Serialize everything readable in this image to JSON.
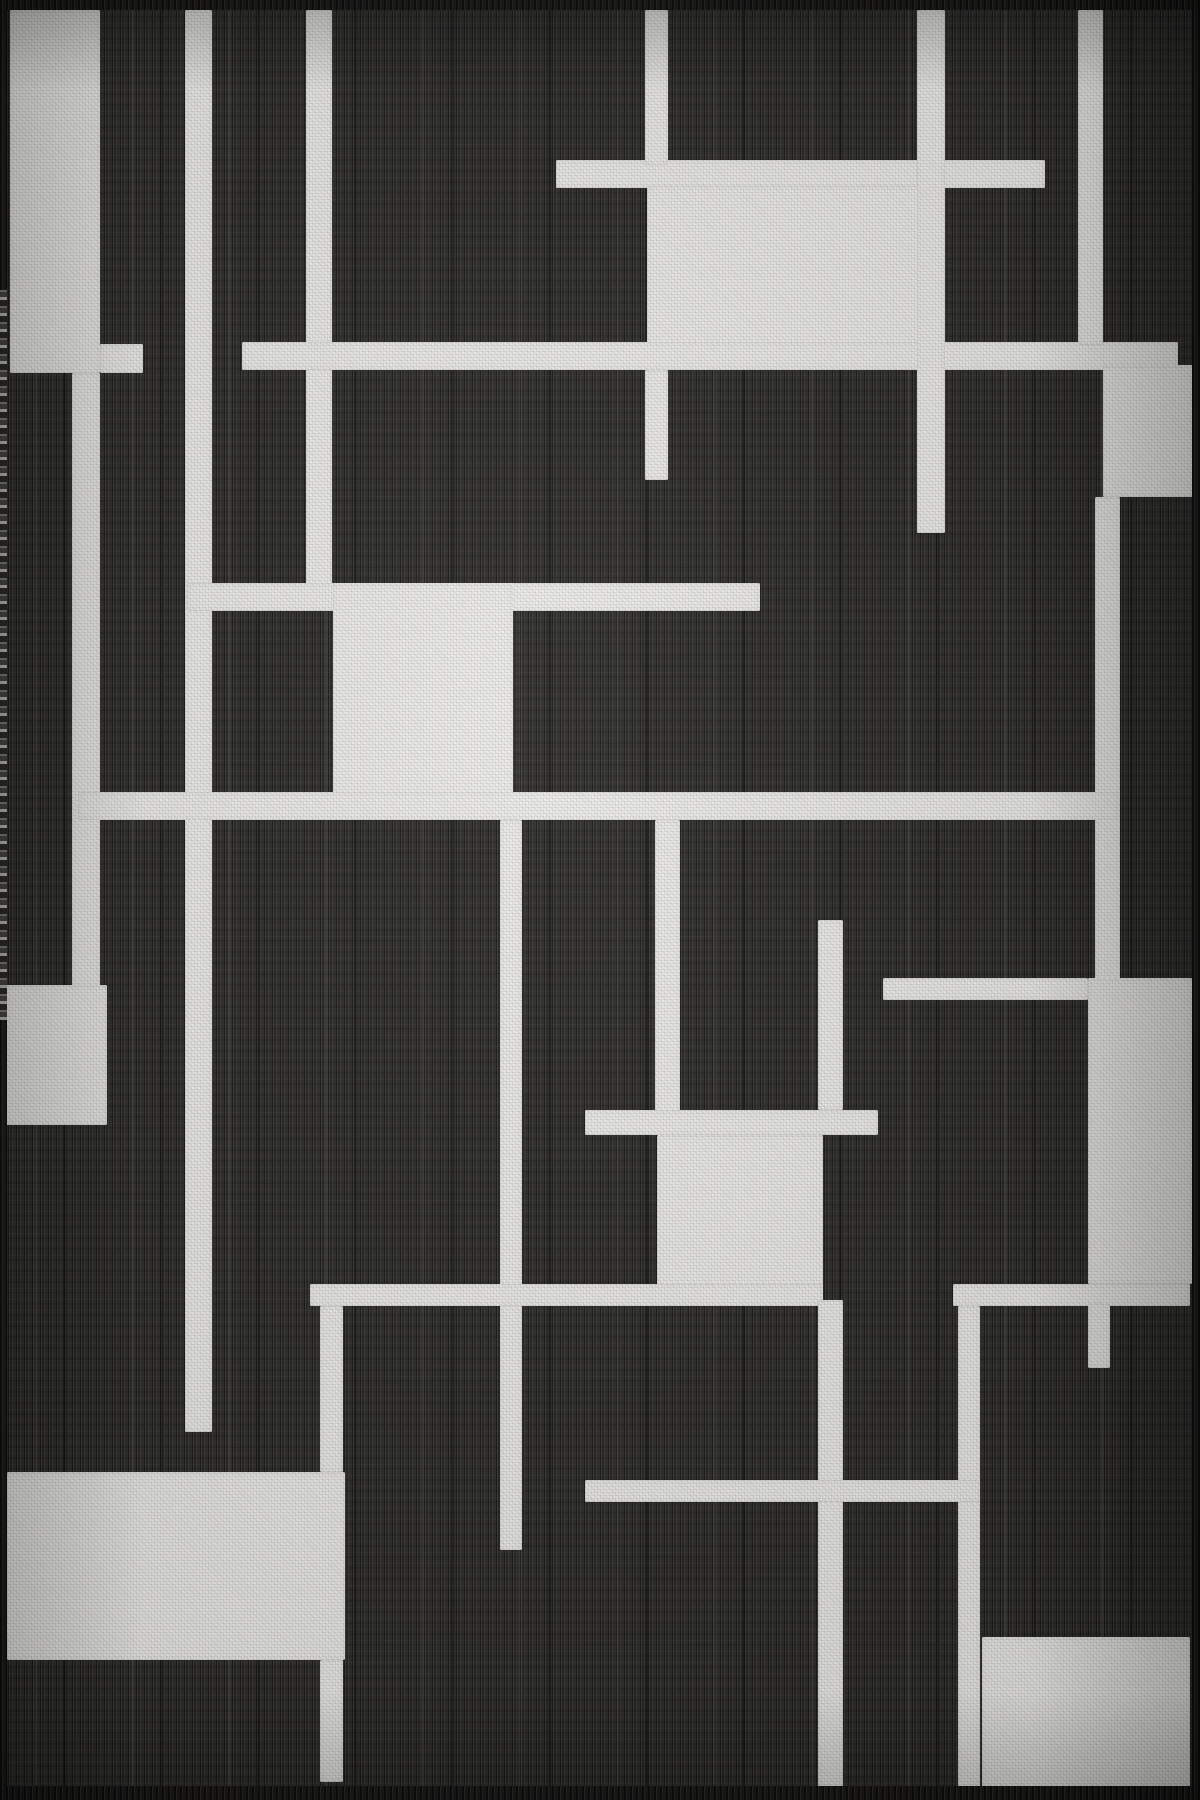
{
  "image": {
    "description": "Flat product photo of a charcoal-black flatweave area rug with an off-white abstract geometric grid pattern of rectangles and intersecting lines, dark selvedge borders and pale fringe on the left edge"
  },
  "rug": {
    "width": 1200,
    "height": 1800,
    "base_color": "#2d2c2a",
    "pattern_color": "#e3e2de",
    "edge_color": "#1b1a18",
    "fringe_color": "#cdcac1",
    "shapes": [
      {
        "name": "rect-left-tall",
        "x": 10,
        "y": 10,
        "w": 90,
        "h": 363
      },
      {
        "name": "arm-left-rect",
        "x": 100,
        "y": 344,
        "w": 43,
        "h": 29
      },
      {
        "name": "strip-left-descender",
        "x": 72,
        "y": 373,
        "w": 28,
        "h": 614
      },
      {
        "name": "rect-left-mid",
        "x": 6,
        "y": 985,
        "w": 101,
        "h": 140
      },
      {
        "name": "vline-1",
        "x": 185,
        "y": 10,
        "w": 27,
        "h": 1422
      },
      {
        "name": "vline-2",
        "x": 306,
        "y": 10,
        "w": 26,
        "h": 601
      },
      {
        "name": "hstrip-top",
        "x": 556,
        "y": 160,
        "w": 489,
        "h": 28
      },
      {
        "name": "vline-3-top",
        "x": 645,
        "y": 10,
        "w": 23,
        "h": 155
      },
      {
        "name": "vline-3-stub",
        "x": 645,
        "y": 370,
        "w": 23,
        "h": 110
      },
      {
        "name": "rect-top-center",
        "x": 647,
        "y": 186,
        "w": 298,
        "h": 184
      },
      {
        "name": "hband-upper",
        "x": 242,
        "y": 342,
        "w": 936,
        "h": 28
      },
      {
        "name": "vline-4",
        "x": 917,
        "y": 10,
        "w": 28,
        "h": 523
      },
      {
        "name": "vline-5",
        "x": 1078,
        "y": 10,
        "w": 25,
        "h": 335
      },
      {
        "name": "rect-right-upper",
        "x": 1103,
        "y": 365,
        "w": 90,
        "h": 132
      },
      {
        "name": "vline-6",
        "x": 1095,
        "y": 497,
        "w": 25,
        "h": 503
      },
      {
        "name": "harm-center",
        "x": 187,
        "y": 583,
        "w": 573,
        "h": 28
      },
      {
        "name": "rect-center-left",
        "x": 333,
        "y": 583,
        "w": 180,
        "h": 237
      },
      {
        "name": "hband-middle",
        "x": 78,
        "y": 792,
        "w": 1040,
        "h": 28
      },
      {
        "name": "vline-12",
        "x": 655,
        "y": 820,
        "w": 25,
        "h": 315
      },
      {
        "name": "vline-8",
        "x": 500,
        "y": 820,
        "w": 22,
        "h": 730
      },
      {
        "name": "vline-10a",
        "x": 818,
        "y": 920,
        "w": 25,
        "h": 190
      },
      {
        "name": "harm-h8",
        "x": 585,
        "y": 1110,
        "w": 293,
        "h": 25
      },
      {
        "name": "rect-center-lower",
        "x": 657,
        "y": 1135,
        "w": 166,
        "h": 170
      },
      {
        "name": "hband-lower-left",
        "x": 310,
        "y": 1284,
        "w": 513,
        "h": 22
      },
      {
        "name": "hband-lower-right",
        "x": 953,
        "y": 1284,
        "w": 237,
        "h": 22
      },
      {
        "name": "harm-h4",
        "x": 883,
        "y": 978,
        "w": 205,
        "h": 22
      },
      {
        "name": "rect-right-mid",
        "x": 1088,
        "y": 978,
        "w": 104,
        "h": 306
      },
      {
        "name": "vstub-11",
        "x": 1088,
        "y": 1303,
        "w": 22,
        "h": 65
      },
      {
        "name": "vline-13",
        "x": 320,
        "y": 1306,
        "w": 23,
        "h": 166
      },
      {
        "name": "rect-bottom-left",
        "x": 7,
        "y": 1472,
        "w": 338,
        "h": 188
      },
      {
        "name": "vline-15",
        "x": 320,
        "y": 1660,
        "w": 23,
        "h": 122
      },
      {
        "name": "vline-10b",
        "x": 818,
        "y": 1300,
        "w": 25,
        "h": 488
      },
      {
        "name": "vline-14",
        "x": 958,
        "y": 1306,
        "w": 22,
        "h": 482
      },
      {
        "name": "hline-h7",
        "x": 585,
        "y": 1480,
        "w": 395,
        "h": 22
      },
      {
        "name": "rect-bottom-right",
        "x": 982,
        "y": 1637,
        "w": 208,
        "h": 150
      }
    ],
    "edges": [
      {
        "name": "rug-edge-top",
        "x": 0,
        "y": 0,
        "w": 1200,
        "h": 10
      },
      {
        "name": "rug-edge-bottom",
        "x": 0,
        "y": 1786,
        "w": 1200,
        "h": 14
      },
      {
        "name": "rug-edge-left",
        "x": 0,
        "y": 0,
        "w": 7,
        "h": 1800
      },
      {
        "name": "rug-edge-right",
        "x": 1192,
        "y": 0,
        "w": 8,
        "h": 1800
      }
    ],
    "fringes": [
      {
        "name": "rug-fringe-left",
        "x": 0,
        "y": 290,
        "w": 7,
        "h": 730
      }
    ]
  }
}
